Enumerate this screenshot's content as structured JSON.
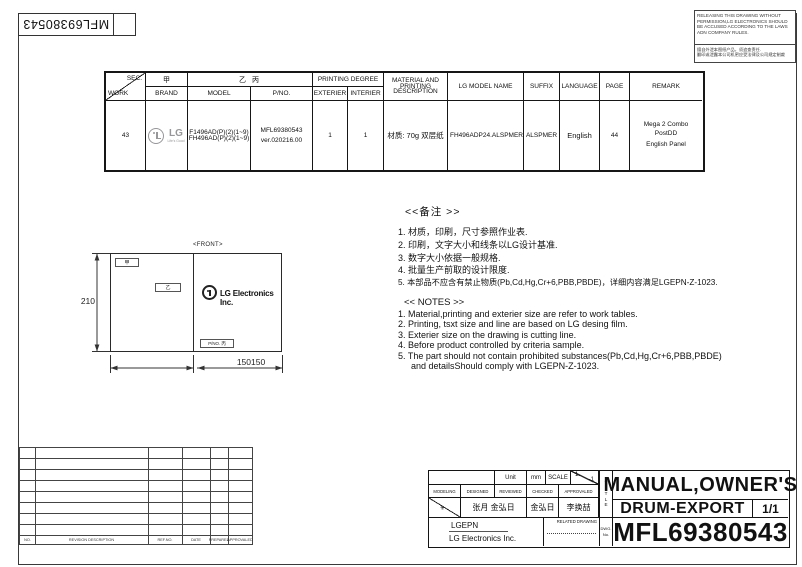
{
  "page": {
    "barcode_number": "MFL69380543",
    "notice_en": "RELEASING THIS DRAWING WITHOUT PERMISSION,LG Electronics SHOULD BE ACCUSED ACCORDING TO THE LAWS ADN COMPANY RULES.",
    "notice_cn1": "擅自外泄本图纸产品，须追查责任.",
    "notice_cn2": "翻印或泄露本公司机密应受法律及公司规定制裁"
  },
  "work_table": {
    "sec_label": "SEC.",
    "work_label": "WORK",
    "col_jia": "甲",
    "col_brand": "BRAND",
    "col_yibing": "乙 丙",
    "col_model": "MODEL",
    "col_pno": "P/NO.",
    "col_printing_degree": "PRINTING DEGREE",
    "col_exterier": "EXTERIER",
    "col_interier": "INTERIER",
    "col_material": "MATERIAL AND PRINTING DESCRIPTION",
    "col_lg_model": "LG MODEL NAME",
    "col_suffix": "SUFFIX",
    "col_language": "LANGUAGE",
    "col_page": "PAGE",
    "col_remark": "REMARK",
    "row": {
      "work": "43",
      "brand_wordmark": "LG",
      "brand_tagline": "Life's Good",
      "model_line1": "F1496AD(P)(2)(1~9)",
      "model_line2": "FH496AD(P)(2)(1~9)",
      "pno_line1": "MFL69380543",
      "pno_line2": "ver.020216.00",
      "exterier": "1",
      "interier": "1",
      "material": "材质: 70g 双层纸",
      "lg_model_name": "FH496ADP24.ALSPMER",
      "suffix": "ALSPMER",
      "language": "English",
      "page": "44",
      "remark_line1": "Mega 2  Combo",
      "remark_line2": "PostDD",
      "remark_line3": "English Panel"
    }
  },
  "front_drawing": {
    "label": "<FRONT>",
    "tag_jia": "甲",
    "tag_yi": "乙",
    "tag_pno": "P/NO. 丙",
    "logo_text": "LG Electronics Inc.",
    "dim_height": "210",
    "dim_width": "150150"
  },
  "notes_cn": {
    "header": "<<备注 >>",
    "items": [
      "1.  材质，印刷，尺寸参照作业表.",
      "2.  印刷，文字大小和线条以LG设计基准.",
      "3.  数字大小依据一般规格.",
      "4.  批量生产前取的设计限度.",
      "5.  本部品不应含有禁止物质(Pb,Cd,Hg,Cr+6,PBB,PBDE)，详细内容满足LGEPN-Z-1023."
    ]
  },
  "notes_en": {
    "header": "<< NOTES >>",
    "items": [
      "1. Material,printing and exterier size are refer to work tables.",
      "2. Printing, tsxt  size and line are based on LG desing film.",
      "3. Exterier size on the drawing is cutting line.",
      "4. Before product controlled by criteria sample.",
      "5. The part should not contain prohibited substances(Pb,Cd,Hg,Cr+6,PBB,PBDE)",
      "and detailsShould comply with LGEPN-Z-1023."
    ]
  },
  "revision_table": {
    "headers": [
      "NO.",
      "REVISION DESCRIPTION",
      "REF.NO.",
      "DATE",
      "PREPARED",
      "APPROVALED"
    ]
  },
  "title_block": {
    "unit_label": "Unit",
    "unit_value": "mm",
    "scale_label": "SCALE",
    "scale_num": "1",
    "scale_den": "1",
    "staff_headers": [
      "MODELING",
      "DESIGNED",
      "REVIEWED",
      "CHECKED",
      "APPROVALED"
    ],
    "designed_name": "张月 金弘日",
    "checked_name": "金弘日",
    "approved_name": "李换喆",
    "company_code": "LGEPN",
    "company_name": "LG Electronics Inc.",
    "related_drawing_label": "RELATED DRAWING",
    "title_letters": [
      "T",
      "I",
      "T",
      "L",
      "E"
    ],
    "dwg_label1": "DWG.",
    "dwg_label2": "No.",
    "title_line1": "MANUAL,OWNER'S",
    "title_line2": "DRUM-EXPORT",
    "sheet": "1/1",
    "drawing_number": "MFL69380543"
  },
  "colors": {
    "line": "#2a2a2a",
    "lg_gray": "#97979a"
  }
}
